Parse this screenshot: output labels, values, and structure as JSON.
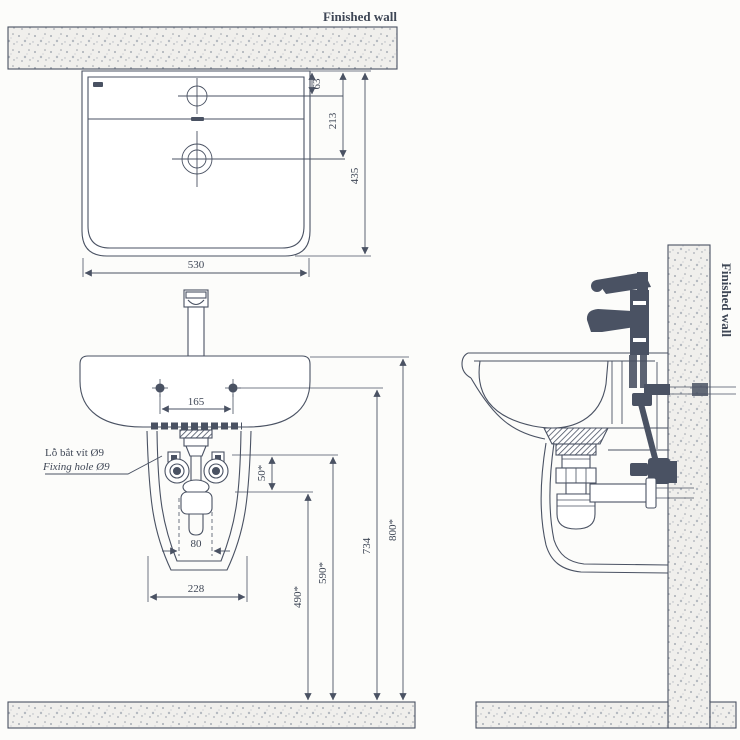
{
  "drawing": {
    "wall_label_top": "Finished wall",
    "wall_label_side": "Finished wall",
    "note_line1": "Lỗ bắt vít Ø9",
    "note_line2": "Fixing hole Ø9"
  },
  "dims": {
    "faucet_to_wall": "63",
    "drain_to_wall": "213",
    "basin_depth": "435",
    "basin_width": "530",
    "fixing_hole_spacing": "165",
    "drain_pipe_width": "80",
    "shroud_width": "228",
    "trap_drop": "50*",
    "h490": "490*",
    "h590": "590*",
    "h734": "734",
    "h800": "800*"
  },
  "colors": {
    "ink": "#4a5263",
    "paper": "#fcfcfa",
    "section_fill": "#f0efec"
  }
}
